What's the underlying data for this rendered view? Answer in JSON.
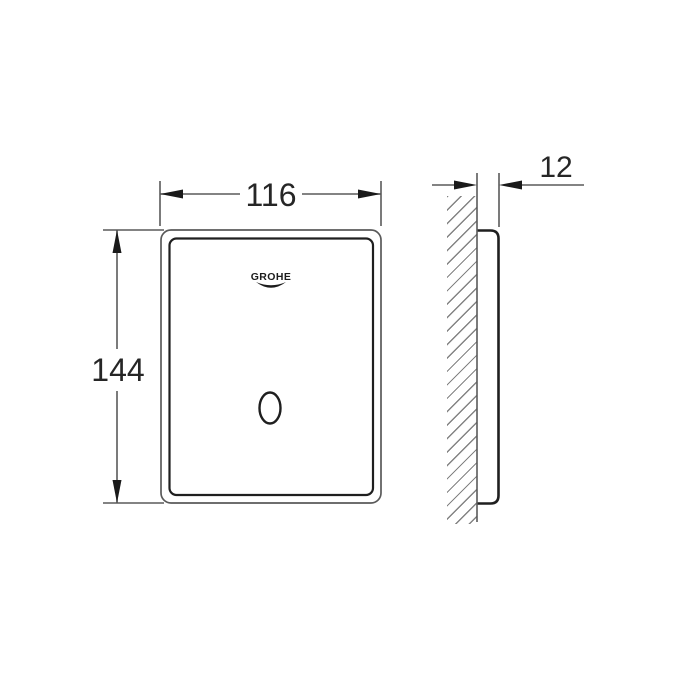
{
  "title": "Flush plate technical dimension drawing",
  "brand_logo": "GROHE",
  "dimensions": {
    "width": "116",
    "height": "144",
    "depth": "12"
  },
  "colors": {
    "background": "#ffffff",
    "thin_line": "#5a5a5a",
    "heavy_line": "#1f1f1f",
    "hatch_line": "#838383",
    "text": "#262626"
  }
}
